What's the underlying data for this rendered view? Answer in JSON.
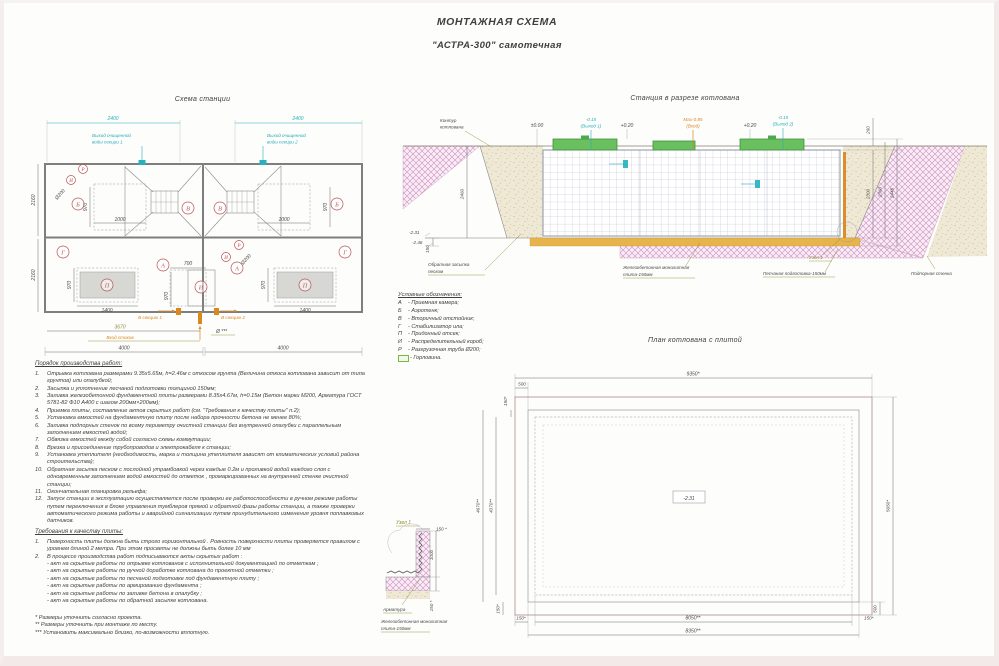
{
  "colors": {
    "cyan": "#2aafbc",
    "orange": "#d9881e",
    "olive": "#8f8c35",
    "letter_red": "#b85450",
    "lid_green": "#5fb85a",
    "hatch_pink": "#cf8fc2",
    "sand_beige": "#efe8d4",
    "sand_orange": "#e6b34c"
  },
  "title": {
    "line1": "МОНТАЖНАЯ СХЕМА",
    "line2": "\"АСТРА-300\" самотечная"
  },
  "station_plan": {
    "title": "Схема станции",
    "dims": {
      "d2400": "2400",
      "d2160": "2160",
      "d970": "970",
      "d1000": "1000",
      "d1400": "1400",
      "d700": "700",
      "d3670": "3670",
      "d4000": "4000",
      "d200": "Ø200",
      "dstars": "Ø ***"
    },
    "labels": {
      "outlet1_l1": "Выход очищенной",
      "outlet1_l2": "воды секции 1",
      "outlet2_l1": "Выход очищенной",
      "outlet2_l2": "воды секции 2",
      "inlet": "Вход стоков",
      "to_section1": "В секцию 1",
      "to_section2": "В секцию 2"
    },
    "letters": {
      "A": "А",
      "B": "Б",
      "V": "В",
      "G": "Г",
      "P": "П",
      "I": "И",
      "R": "Р"
    }
  },
  "cross_section": {
    "title": "Станция в разрезе котлована",
    "labels": {
      "contour_l1": "Контур",
      "contour_l2": "котлована",
      "backfill_l1": "Обратная засыпка",
      "backfill_l2": "песком",
      "plate_l1": "Железобетонная монолитная",
      "plate_l2": "плита-150мм",
      "sand_prep": "Песчаная подготовка-150мм",
      "retaining": "Подпорная стенка",
      "node": "Узел 1"
    },
    "elevations": {
      "zero": "±0.00",
      "out1_l1": "-0.15",
      "out1_l2": "(Выход 1)",
      "p020": "+0.20",
      "inlet_l1": "Мах-0.85",
      "inlet_l2": "(Вход)",
      "out2_l1": "-0.15",
      "out2_l2": "(Выход 2)",
      "bottom1": "-2.31",
      "bottom2": "-2.46"
    },
    "dims": {
      "d260": "260",
      "d2300": "2300",
      "d2360": "2360",
      "d2445": "2445",
      "d2460": "2460",
      "d150": "150"
    }
  },
  "legend": {
    "title": "Условные обозначения:",
    "items": [
      {
        "k": "А",
        "t": "- Приемная камера;"
      },
      {
        "k": "Б",
        "t": "- Аэротенк;"
      },
      {
        "k": "В",
        "t": "- Вторичный отстойник;"
      },
      {
        "k": "Г",
        "t": "- Стабилизатор ила;"
      },
      {
        "k": "П",
        "t": "- Придонный отсек;"
      },
      {
        "k": "И",
        "t": "- Распределительный короб;"
      },
      {
        "k": "Р",
        "t": "- Разгрузочная труба Ø200;"
      }
    ],
    "gorlovina": "- Горловина."
  },
  "pit_plan": {
    "title": "План котлована с плитой",
    "dims": {
      "d9350": "9350*",
      "d500": "500",
      "d150": "150*",
      "d4670": "4670**",
      "d4370": "4370**",
      "d5650": "5650*",
      "d8050": "8050**",
      "d8350": "8350**"
    },
    "elevation": "-2.31"
  },
  "node_detail": {
    "title": "Узел 1",
    "dims": {
      "d150": "150 *",
      "d1000": "1000"
    },
    "labels": {
      "rebar": "Арматура",
      "plate_l1": "Железобетонная монолитная",
      "plate_l2": "плита-150мм"
    }
  },
  "work_order": {
    "title": "Порядок производства работ:",
    "items": [
      {
        "n": "1.",
        "t": "Отрывка котлована размерами 9.35х5.65м, h=2.46м с откосом грунта (Величина откоса котлована зависит от типа грунтов) или опалубкой;"
      },
      {
        "n": "2.",
        "t": "Засыпка и уплотнение песчаной подготовки толщиной 150мм;"
      },
      {
        "n": "3.",
        "t": "Заливка железобетонной фундаментной плиты размерами 8.35х4.67м, h=0.15м (Бетон марки М200, Арматура ГОСТ 5781-82 Ф10 А400 с шагом 200мм×200мм);"
      },
      {
        "n": "4.",
        "t": "Приемка плиты, составление актов скрытых работ (см. \"Требования к качеству плиты\" п.2);"
      },
      {
        "n": "5.",
        "t": "Установка емкостей на фундаментную плиту после набора прочности бетона не менее  80%;"
      },
      {
        "n": "6.",
        "t": "Заливка подпорных стенок по всему периметру очистной станции без внутренней опалубки с параллельным заполнением емкостей водой;"
      },
      {
        "n": "7.",
        "t": "Обвязка емкостей между собой согласно схемы коммутации;"
      },
      {
        "n": "8.",
        "t": "Врезка и присоединение трубопроводов и электрокабеля к станции;"
      },
      {
        "n": "9.",
        "t": "Установка утеплителя (необходимость, марка и толщина утеплителя зависят от климатических условий района строительства);"
      },
      {
        "n": "10.",
        "t": "Обратная засыпка песком с послойной утрамбовкой через каждые  0.2м и проливкой водой каждого слоя с одновременным заполнением водой емкостей до отметок , промаркированных на внутренней стенке очистной станции;"
      },
      {
        "n": "11.",
        "t": "Окончательная планировка рельефа;"
      },
      {
        "n": "12.",
        "t": "Запуск станции в эксплуатацию осуществляется после проверки ее работоспособности в ручном режиме работы путем переключения в блоке управления тумблеров прямой и обратной фазы работы станции, а также проверки автоматического режима работы и аварийной сигнализации путем принудительного изменения уровня поплавковых датчиков."
      }
    ]
  },
  "requirements": {
    "title": "Требования к качеству плиты:",
    "items": [
      {
        "n": "1.",
        "t": "Поверхность плиты должна быть строго горизонтальной . Ровность поверхности плиты проверяется правилом с уровнем длиной 2 метра. При этом просветы не должны быть    более 10 мм"
      },
      {
        "n": "2.",
        "t": "В процессе производства работ подписываются акты скрытых работ :"
      }
    ],
    "acts": [
      {
        "t": "- акт на скрытые работы по отрывке котлованов с исполнительной документацией по отметкам ;"
      },
      {
        "t": "- акт на скрытые работы по ручной доработке котлована до проектной отметки ;"
      },
      {
        "t": "- акт на скрытые работы по песчаной подготовке под фундаментную плиту ;"
      },
      {
        "t": "- акт на скрытые работы по армированию фундамента ;"
      },
      {
        "t": "- акт на скрытые работы по заливке бетона в опалубку ;"
      },
      {
        "t": "- акт на скрытые работы по обратной засыпке котлована."
      }
    ]
  },
  "footnotes": {
    "items": [
      {
        "t": "* Размеры уточнить согласно проекта."
      },
      {
        "t": "** Размеры уточнить при монтаже по месту."
      },
      {
        "t": "*** Установить максимально близко, по-возможности вплотную."
      }
    ]
  }
}
